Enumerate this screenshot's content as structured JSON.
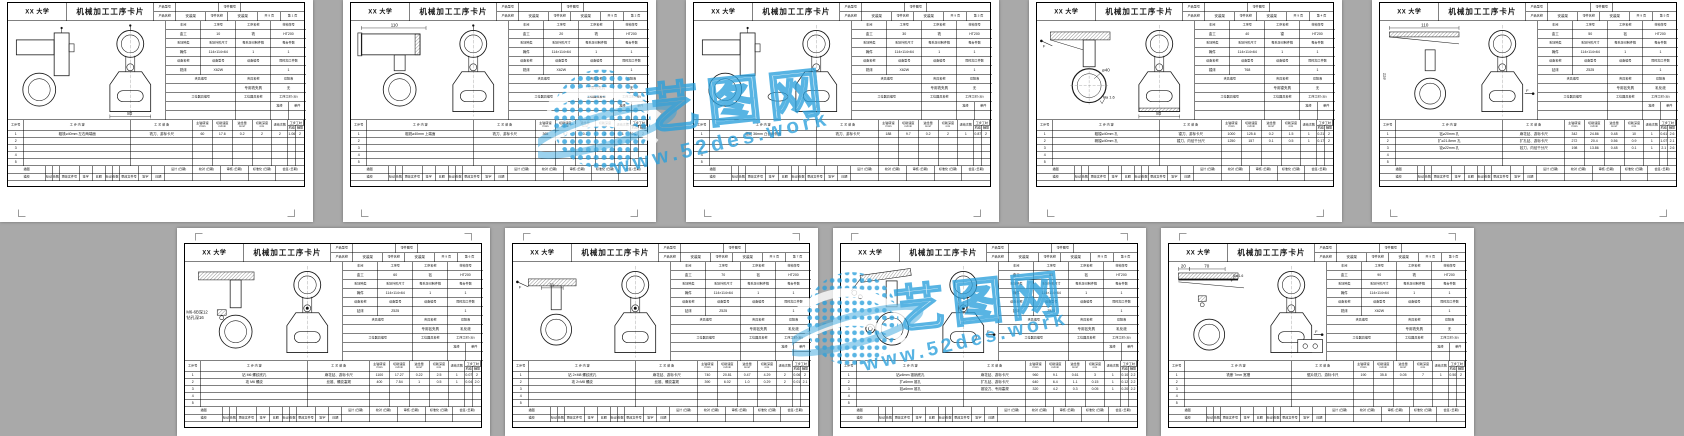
{
  "window": {
    "canvas_color": "#a9a9a9",
    "page_color": "#ffffff"
  },
  "watermark": {
    "site_name": "艺图网",
    "site_url": "www.52des.work",
    "color": "#2aa0dc"
  },
  "shared": {
    "university": "XX 大学",
    "card_title": "机械加工工序卡片",
    "header": {
      "product_model_label": "产品型号",
      "product_model": "",
      "part_no_label": "零件图号",
      "part_no": "",
      "product_name_label": "产品名称",
      "product_name": "安装架",
      "part_name_label": "零件名称",
      "part_name": "安装架",
      "total_pages": "共 9 页"
    },
    "info_labels": {
      "workshop": "车间",
      "op_no": "工序号",
      "op_name": "工序名称",
      "material": "材料牌号",
      "blank_type": "毛坯种类",
      "blank_size": "毛坯外形尺寸",
      "per_blank": "每毛坯可制件数",
      "per_unit": "每台件数",
      "equip_name": "设备名称",
      "equip_model": "设备型号",
      "equip_no": "设备编号",
      "simultaneous": "同时加工件数",
      "fixture_no": "夹具编号",
      "fixture_name": "夹具名称",
      "coolant": "切削液",
      "tool_no": "工位器具编号",
      "tool_name": "工位器具名称",
      "op_time": "工序工时 (分)",
      "prep": "准终",
      "single": "单件"
    },
    "steps_labels": {
      "step_no": "工步号",
      "content": "工 步 内 容",
      "equipment": "工 艺 装 备",
      "spindle": "主轴转速",
      "spindle_unit": "r/min",
      "speed": "切削速度",
      "speed_unit": "m/min",
      "feed": "进给量",
      "feed_unit": "mm/r",
      "depth": "切削深度",
      "depth_unit": "mm",
      "passes": "进给次数",
      "time": "工步工时",
      "machine": "机动",
      "aux": "辅助"
    },
    "footer_labels": {
      "trace": "描图",
      "trace_check": "描校",
      "mark": "标记",
      "count": "处数",
      "change_no": "更改文件号",
      "sign": "签字",
      "date": "日期",
      "design": "设计 (日期)",
      "check": "校对 (日期)",
      "audit": "审核 (日期)",
      "standard": "标准化 (日期)",
      "countersign": "会签 (日期)"
    }
  },
  "pages": [
    {
      "page_label": "第 1 页",
      "info": {
        "workshop": "金工",
        "op_no": "10",
        "op_name": "铣",
        "material": "HT200",
        "blank_type": "铸件",
        "blank_size": "114×114×64",
        "per_blank": "1",
        "per_unit": "1",
        "equip_name": "铣床",
        "equip_model": "X62W",
        "equip_no": "",
        "simultaneous": "1",
        "fixture_no": "",
        "fixture_name": "专用铣夹具",
        "coolant": "无",
        "tool_no": "",
        "tool_name": "",
        "prep": "",
        "single": ""
      },
      "drawing": {
        "variant": "v1",
        "dims": [],
        "labels": [],
        "side_label": "",
        "notes": [],
        "front_dim": "80",
        "flags": [
          "top-pin"
        ]
      },
      "steps": [
        {
          "content": "粗铣⌀40mm 左右两端面",
          "equipment": "铣刀、游标卡尺",
          "spindle": "60",
          "speed": "17.6",
          "feed": "0.2",
          "depth": "2",
          "passes": "2",
          "machine": "1.06",
          "aux": "2"
        }
      ]
    },
    {
      "page_label": "第 2 页",
      "info": {
        "workshop": "金工",
        "op_no": "20",
        "op_name": "铣",
        "material": "HT200",
        "blank_type": "铸件",
        "blank_size": "114×114×64",
        "per_blank": "1",
        "per_unit": "1",
        "equip_name": "铣床",
        "equip_model": "X62W",
        "equip_no": "",
        "simultaneous": "1",
        "fixture_no": "",
        "fixture_name": "专用铣夹具",
        "coolant": "无",
        "tool_no": "",
        "tool_name": "",
        "prep": "",
        "single": ""
      },
      "drawing": {
        "variant": "v2",
        "dims": [
          "110"
        ],
        "labels": [],
        "side_label": "",
        "notes": [],
        "front_dim": "",
        "flags": [
          "top-pin"
        ]
      },
      "steps": [
        {
          "content": "粗铣⌀40mm 上端面",
          "equipment": "铣刀、游标卡尺",
          "spindle": "365",
          "speed": "9.7",
          "feed": "0.2",
          "depth": "2",
          "passes": "1",
          "machine": "0.64",
          "aux": "2"
        }
      ]
    },
    {
      "page_label": "第 3 页",
      "info": {
        "workshop": "金工",
        "op_no": "30",
        "op_name": "铣",
        "material": "HT200",
        "blank_type": "铸件",
        "blank_size": "114×114×64",
        "per_blank": "1",
        "per_unit": "1",
        "equip_name": "铣床",
        "equip_model": "X62W",
        "equip_no": "",
        "simultaneous": "1",
        "fixture_no": "",
        "fixture_name": "专用铣夹具",
        "coolant": "无",
        "tool_no": "",
        "tool_name": "",
        "prep": "",
        "single": ""
      },
      "drawing": {
        "variant": "v3",
        "dims": [],
        "labels": [],
        "side_label": "",
        "notes": [],
        "front_dim": "",
        "flags": []
      },
      "steps": [
        {
          "content": "粗铣 36mm 凸台两侧面",
          "equipment": "铣刀、游标卡尺",
          "spindle": "188",
          "speed": "9.7",
          "feed": "0.2",
          "depth": "2",
          "passes": "1",
          "machine": "0.87",
          "aux": "2"
        }
      ]
    },
    {
      "page_label": "第 4 页",
      "info": {
        "workshop": "金工",
        "op_no": "40",
        "op_name": "镗",
        "material": "HT200",
        "blank_type": "铸件",
        "blank_size": "114×114×64",
        "per_blank": "1",
        "per_unit": "1",
        "equip_name": "镗床",
        "equip_model": "T68",
        "equip_no": "",
        "simultaneous": "1",
        "fixture_no": "",
        "fixture_name": "专用镗夹具",
        "coolant": "无",
        "tool_no": "",
        "tool_name": "",
        "prep": "",
        "single": ""
      },
      "drawing": {
        "variant": "v4",
        "dims": [],
        "labels": [
          "⌀40",
          "Ra 1.6"
        ],
        "side_label": "",
        "notes": [],
        "front_dim": "80",
        "flags": [
          "arrow-left",
          "hatch-base"
        ]
      },
      "steps": [
        {
          "content": "粗镗⌀40mm 孔",
          "equipment": "镗刀、游标卡尺",
          "spindle": "1000",
          "speed": "125.6",
          "feed": "0.2",
          "depth": "1.5",
          "passes": "1",
          "machine": "0.21",
          "aux": "2"
        },
        {
          "content": "精镗⌀40mm 孔",
          "equipment": "镗刀、内径千分尺",
          "spindle": "1250",
          "speed": "157",
          "feed": "0.1",
          "depth": "0.5",
          "passes": "1",
          "machine": "0.17",
          "aux": "2"
        }
      ]
    },
    {
      "page_label": "第 5 页",
      "info": {
        "workshop": "金工",
        "op_no": "50",
        "op_name": "钻",
        "material": "HT200",
        "blank_type": "铸件",
        "blank_size": "114×114×64",
        "per_blank": "1",
        "per_unit": "1",
        "equip_name": "钻床",
        "equip_model": "Z525",
        "equip_no": "",
        "simultaneous": "1",
        "fixture_no": "",
        "fixture_name": "专用钻夹具",
        "coolant": "乳化液",
        "tool_no": "",
        "tool_name": "",
        "prep": "",
        "single": ""
      },
      "drawing": {
        "variant": "v5",
        "dims": [
          "110"
        ],
        "labels": [],
        "side_label": "⌀22",
        "notes": [],
        "front_dim": "",
        "flags": [
          "arrow-right"
        ]
      },
      "steps": [
        {
          "content": "钻⌀20mm 孔",
          "equipment": "麻花钻、游标卡尺",
          "spindle": "342",
          "speed": "24.86",
          "feed": "0.48",
          "depth": "10",
          "passes": "1",
          "machine": "0.61",
          "aux": "2.6"
        },
        {
          "content": "扩⌀21.8mm 孔",
          "equipment": "扩孔钻、游标卡尺",
          "spindle": "272",
          "speed": "20.4",
          "feed": "0.56",
          "depth": "0.9",
          "passes": "1",
          "machine": "1.07",
          "aux": "2.1"
        },
        {
          "content": "铰⌀22mm 孔",
          "equipment": "铰刀、内径千分尺",
          "spindle": "198",
          "speed": "13.86",
          "feed": "0.48",
          "depth": "0.1",
          "passes": "1",
          "machine": "2.1",
          "aux": "2.6"
        }
      ]
    },
    {
      "page_label": "第 6 页",
      "info": {
        "workshop": "金工",
        "op_no": "60",
        "op_name": "钻",
        "material": "HT200",
        "blank_type": "铸件",
        "blank_size": "114×114×64",
        "per_blank": "1",
        "per_unit": "1",
        "equip_name": "钻床",
        "equip_model": "Z525",
        "equip_no": "",
        "simultaneous": "1",
        "fixture_no": "",
        "fixture_name": "专用钻夹具",
        "coolant": "乳化液",
        "tool_no": "",
        "tool_name": "",
        "prep": "",
        "single": ""
      },
      "drawing": {
        "variant": "v6",
        "dims": [],
        "labels": [],
        "side_label": "",
        "notes": [
          "M6-6B深12",
          "钻孔深16"
        ],
        "front_dim": "",
        "flags": [
          "front-dot"
        ]
      },
      "steps": [
        {
          "content": "钻 M6 螺纹底孔",
          "equipment": "麻花钻、游标卡尺",
          "spindle": "1100",
          "speed": "17.27",
          "feed": "0.22",
          "depth": "2.5",
          "passes": "1",
          "machine": "0.07",
          "aux": "2"
        },
        {
          "content": "攻 M6 螺纹",
          "equipment": "丝锥、螺纹塞规",
          "spindle": "400",
          "speed": "7.54",
          "feed": "1",
          "depth": "0.5",
          "passes": "1",
          "machine": "0.04",
          "aux": "2.0"
        }
      ]
    },
    {
      "page_label": "第 7 页",
      "info": {
        "workshop": "金工",
        "op_no": "70",
        "op_name": "钻",
        "material": "HT200",
        "blank_type": "铸件",
        "blank_size": "114×114×64",
        "per_blank": "1",
        "per_unit": "1",
        "equip_name": "钻床",
        "equip_model": "Z525",
        "equip_no": "",
        "simultaneous": "1",
        "fixture_no": "",
        "fixture_name": "专用钻夹具",
        "coolant": "乳化液",
        "tool_no": "",
        "tool_name": "",
        "prep": "",
        "single": ""
      },
      "drawing": {
        "variant": "v7",
        "dims": [
          "31"
        ],
        "labels": [],
        "side_label": "",
        "notes": [],
        "front_dim": "",
        "flags": [
          "arrow-left",
          "front-dot"
        ]
      },
      "steps": [
        {
          "content": "钻 2×M8 螺纹底孔",
          "equipment": "麻花钻、游标卡尺",
          "spindle": "740",
          "speed": "20.81",
          "feed": "0.47",
          "depth": "4.29",
          "passes": "2",
          "machine": "0.06",
          "aux": "2"
        },
        {
          "content": "攻 2×M8 螺纹",
          "equipment": "丝锥、螺纹塞规",
          "spindle": "390",
          "speed": "6.02",
          "feed": "1.0",
          "depth": "0.29",
          "passes": "2",
          "machine": "0.01",
          "aux": "2.1"
        }
      ]
    },
    {
      "page_label": "第 8 页",
      "info": {
        "workshop": "金工",
        "op_no": "80",
        "op_name": "钻",
        "material": "HT200",
        "blank_type": "铸件",
        "blank_size": "114×114×64",
        "per_blank": "1",
        "per_unit": "1",
        "equip_name": "钻床",
        "equip_model": "Z525",
        "equip_no": "",
        "simultaneous": "1",
        "fixture_no": "",
        "fixture_name": "专用钻夹具",
        "coolant": "乳化液",
        "tool_no": "",
        "tool_name": "",
        "prep": "",
        "single": ""
      },
      "drawing": {
        "variant": "v8",
        "dims": [],
        "labels": [],
        "side_label": "",
        "notes": [],
        "front_dim": "",
        "flags": [
          "arrow-right",
          "front-dot"
        ]
      },
      "steps": [
        {
          "content": "钻⌀6mm 锥销底孔",
          "equipment": "麻花钻、游标卡尺",
          "spindle": "960",
          "speed": "9.1",
          "feed": "0.61",
          "depth": "3",
          "passes": "1",
          "machine": "0.10",
          "aux": "2.2"
        },
        {
          "content": "扩⌀6mm 锥孔",
          "equipment": "扩孔钻、游标卡尺",
          "spindle": "640",
          "speed": "6.4",
          "feed": "1.1",
          "depth": "0.15",
          "passes": "1",
          "machine": "0.12",
          "aux": "2.2"
        },
        {
          "content": "铰⌀6mm 锥孔",
          "equipment": "锥铰刀、专用塞规",
          "spindle": "320",
          "speed": "4.2",
          "feed": "0.3",
          "depth": "0.05",
          "passes": "1",
          "machine": "0.20",
          "aux": "2.2"
        }
      ]
    },
    {
      "page_label": "第 9 页",
      "info": {
        "workshop": "金工",
        "op_no": "90",
        "op_name": "铣",
        "material": "HT200",
        "blank_type": "铸件",
        "blank_size": "114×114×64",
        "per_blank": "1",
        "per_unit": "1",
        "equip_name": "铣床",
        "equip_model": "X62W",
        "equip_no": "",
        "simultaneous": "1",
        "fixture_no": "",
        "fixture_name": "专用铣夹具",
        "coolant": "无",
        "tool_no": "",
        "tool_name": "",
        "prep": "",
        "single": ""
      },
      "drawing": {
        "variant": "v9",
        "dims": [
          "20",
          "70"
        ],
        "labels": [
          "Ra 1.6"
        ],
        "side_label": "",
        "notes": [],
        "front_dim": "",
        "flags": [
          "arrow-right",
          "plate-holes"
        ]
      },
      "steps": [
        {
          "content": "铣断 7mm 宽槽",
          "equipment": "锯片铣刀、游标卡尺",
          "spindle": "190",
          "speed": "35.8",
          "feed": "0.05",
          "depth": "7",
          "passes": "1",
          "machine": "0.50",
          "aux": "2"
        }
      ]
    }
  ]
}
